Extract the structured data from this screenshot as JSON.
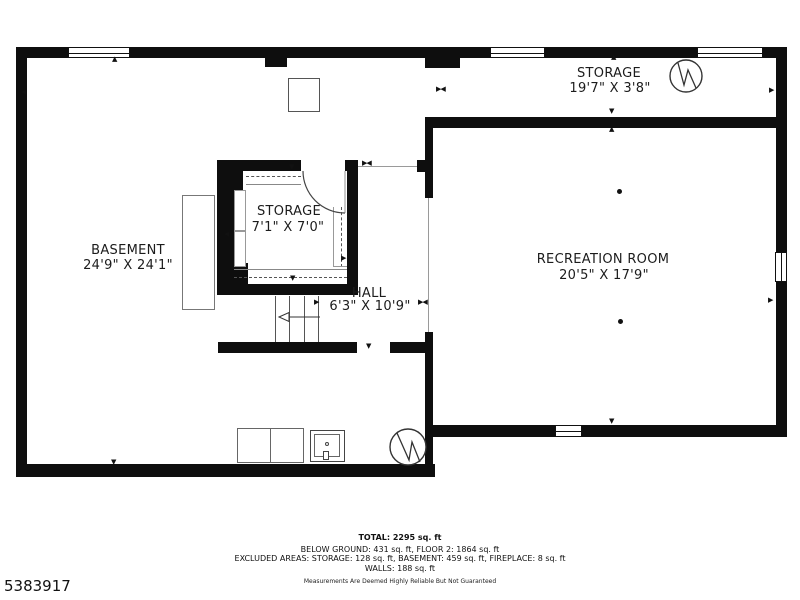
{
  "plan": {
    "rooms": [
      {
        "name": "STORAGE",
        "dims": "19'7\" X 3'8\""
      },
      {
        "name": "RECREATION ROOM",
        "dims": "20'5\" X 17'9\""
      },
      {
        "name": "BASEMENT",
        "dims": "24'9\" X 24'1\""
      },
      {
        "name": "STORAGE",
        "dims": "7'1\" X 7'0\""
      },
      {
        "name": "HALL",
        "dims": "6'3\" X 10'9\""
      }
    ]
  },
  "footer": {
    "total": "TOTAL: 2295 sq. ft",
    "below_ground": "BELOW GROUND: 431 sq. ft, FLOOR 2: 1864 sq. ft",
    "excluded": "EXCLUDED AREAS: STORAGE: 128 sq. ft, BASEMENT: 459 sq. ft, FIREPLACE: 8 sq. ft",
    "walls": "WALLS: 188 sq. ft",
    "disclaimer": "Measurements Are Deemed Highly Reliable But Not Guaranteed"
  },
  "listing_id": "5383917",
  "icons": {
    "tri_up": "▲",
    "tri_down": "▼",
    "tri_left": "◀",
    "tri_right": "▶",
    "tri_pair": "▶◀"
  }
}
